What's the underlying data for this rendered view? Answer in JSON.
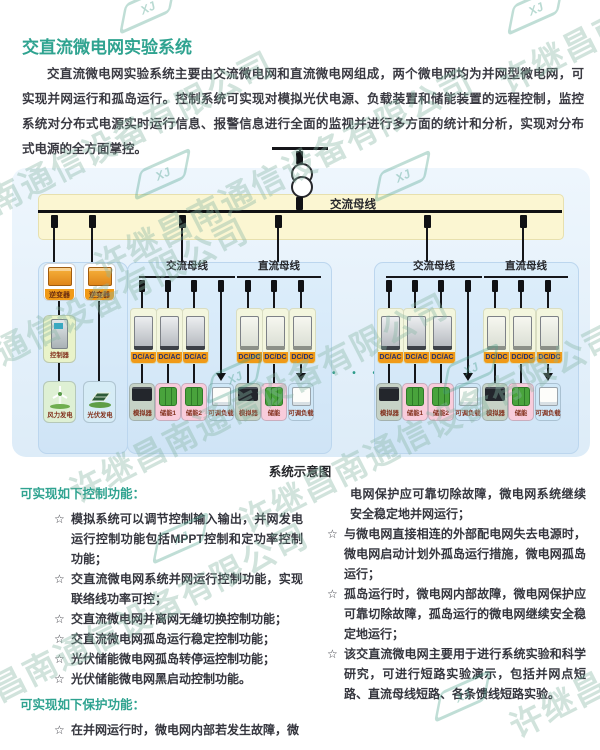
{
  "watermark": {
    "company": "许继昌南通信设备有限公司",
    "logo_text": "XJ"
  },
  "colors": {
    "title_teal": "#2fa390",
    "bus_band_yellow": "#fbf6d2",
    "panel_blue": "#d9eaf8",
    "badge_orange": "#f09a18",
    "badge_text_navy": "#26306e",
    "device_label_red": "#82301c",
    "watermark_green": "#86b5a3"
  },
  "header": {
    "title": "交直流微电网实验系统",
    "intro": "交直流微电网实验系统主要由交流微电网和直流微电网组成，两个微电网均为并网型微电网，可实现并网运行和孤岛运行。控制系统可实现对模拟光伏电源、负载装置和储能装置的远程控制，监控系统对分布式电源实时运行信息、报警信息进行全面的监视并进行多方面的统计和分析，实现对分布式电源的全方面掌控。"
  },
  "diagram": {
    "caption": "系统示意图",
    "grid_bus_label": "交流母线",
    "ellipsis": "• • •",
    "left_panel": {
      "inverter": "逆变器",
      "controller": "控制器",
      "wind": "风力发电",
      "pv": "光伏发电"
    },
    "subgrid": {
      "ac_bus_label": "交流母线",
      "dc_bus_label": "直流母线",
      "ac_converter": "DC/AC",
      "dc_converter": "DC/DC",
      "ac_devices": [
        "模拟器",
        "储能1",
        "储能2",
        "可调负载"
      ],
      "dc_devices": [
        "模拟器",
        "储能",
        "可调负载"
      ]
    }
  },
  "sections": {
    "bullet_icon": "☆",
    "control": {
      "heading": "可实现如下控制功能：",
      "bullets": [
        "模拟系统可以调节控制输入输出，并网发电运行控制功能包括MPPT控制和定功率控制功能；",
        "交直流微电网系统并网运行控制功能，实现联络线功率可控；",
        "交直流微电网并离网无缝切换控制功能；",
        "交直流微电网孤岛运行稳定控制功能；",
        "光伏储能微电网孤岛转停运控制功能；",
        "光伏储能微电网黑启动控制功能。"
      ]
    },
    "protection": {
      "heading": "可实现如下保护功能：",
      "first_bullet_start": "在并网运行时，微电网内部若发生故障，微",
      "first_bullet_continuation": "电网保护应可靠切除故障，微电网系统继续安全稳定地并网运行；",
      "bullets": [
        "与微电网直接相连的外部配电网失去电源时，微电网启动计划外孤岛运行措施，微电网孤岛运行；",
        "孤岛运行时，微电网内部故障，微电网保护应可靠切除故障，孤岛运行的微电网继续安全稳定地运行；",
        "该交直流微电网主要用于进行系统实验和科学研究，可进行短路实验演示，包括并网点短路、直流母线短路、各条馈线短路实验。"
      ]
    }
  }
}
